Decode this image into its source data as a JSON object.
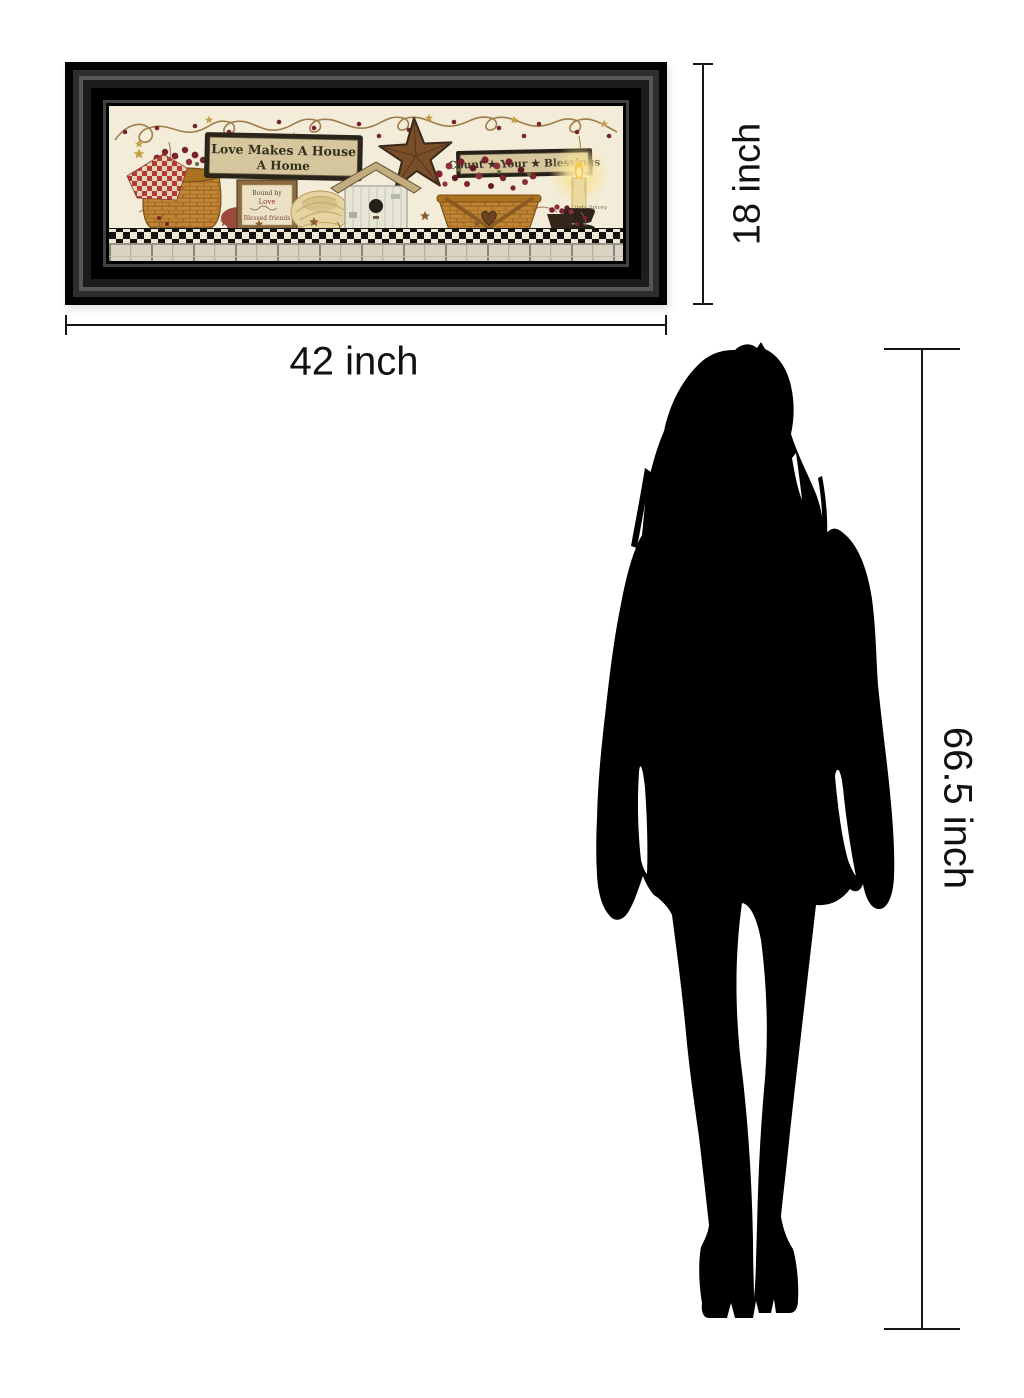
{
  "scene": {
    "background": "#ffffff"
  },
  "artwork": {
    "frame_color": "#0b0b0b",
    "art_background": "#f3ecd8",
    "main_sign": {
      "line1": "Love Makes A House",
      "line2": "A Home"
    },
    "blessings_sign": {
      "text": "Count ★ Your ★ Blessings"
    },
    "small_sign": {
      "line1": "Bound by",
      "line2": "Love",
      "line3": "Blessed friends"
    },
    "artist_signature": "Linda Spivey"
  },
  "dimensions": {
    "frame_width_label": "42 inch",
    "frame_height_label": "18 inch",
    "figure_height_label": "66.5 inch"
  },
  "figure": {
    "name": "woman-silhouette",
    "color": "#000000"
  },
  "colors": {
    "dimension_line": "#161616",
    "sign_background": "#d6c69e",
    "sign_border": "#25211a",
    "basket": "#c08432",
    "berry": "#7b2230",
    "rust_star": "#7a4e28",
    "checker_dark": "#16130e",
    "plank": "#d8d3c2"
  }
}
